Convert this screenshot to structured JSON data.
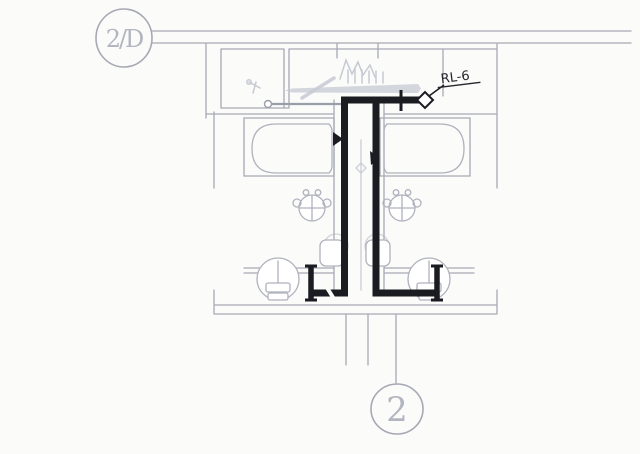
{
  "labels": {
    "grid_bubble": "2/D",
    "section_bubble": "2",
    "pipe_tag": "RL-6"
  },
  "colors": {
    "paper": "#fbfbfa",
    "wall": "#a8aab5",
    "sketch": "#c7c9d3",
    "fixture": "#b0b2bd",
    "thin_pipe": "#999ea9",
    "pipe": "#1b1b22",
    "bubble": "#a6a8b3",
    "bubble_text": "#b3b5c0",
    "label_text": "#26262e"
  },
  "diagram": {
    "type": "plumbing-floor-plan-detail",
    "fixtures": [
      "bathtub-left",
      "bathtub-right",
      "washbasin-left",
      "washbasin-right",
      "toilet-left",
      "toilet-right",
      "floor-drain-left",
      "floor-drain-right"
    ],
    "pipe_runs": [
      "main-drain-run",
      "branch-drain-run",
      "toilet-branch-left",
      "toilet-branch-right"
    ]
  }
}
